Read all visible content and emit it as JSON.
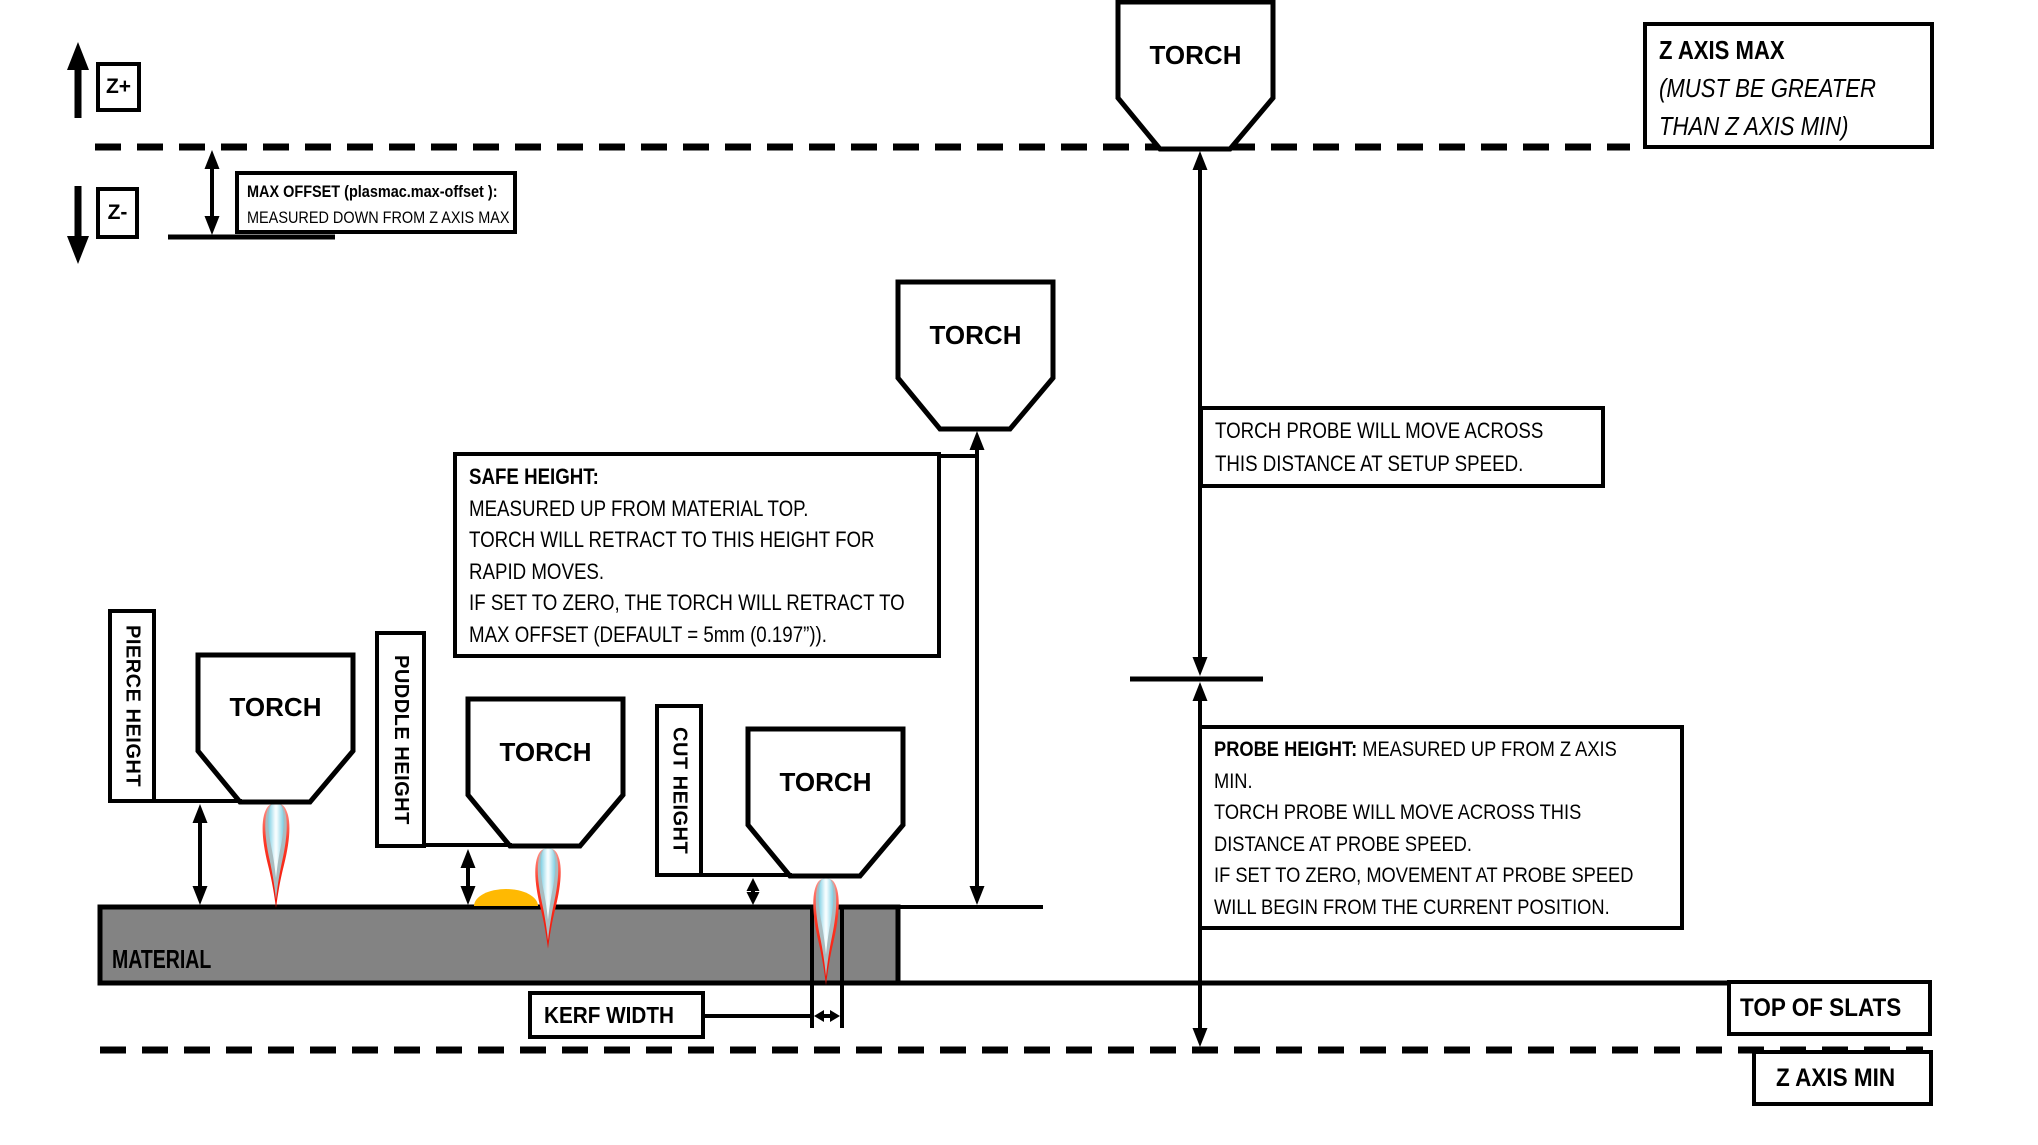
{
  "axis_legend": {
    "z_plus": "Z+",
    "z_minus": "Z-"
  },
  "torch_label": "TORCH",
  "max_offset": {
    "line1": "MAX OFFSET (plasmac.max-offset ):",
    "line2": "MEASURED DOWN FROM Z AXIS MAX"
  },
  "z_axis_max": {
    "title": "Z AXIS MAX",
    "note1": "(MUST BE GREATER",
    "note2": "THAN Z AXIS MIN)"
  },
  "safe_height": {
    "title": "SAFE HEIGHT:",
    "line2": "MEASURED UP FROM MATERIAL TOP.",
    "line3": "TORCH WILL RETRACT TO THIS HEIGHT FOR",
    "line4": "RAPID MOVES.",
    "line5": "IF SET TO ZERO, THE TORCH WILL RETRACT TO",
    "line6": "MAX OFFSET (DEFAULT = 5mm (0.197”))."
  },
  "torch_probe": {
    "line1": "TORCH PROBE WILL MOVE ACROSS",
    "line2": "THIS DISTANCE AT SETUP SPEED."
  },
  "probe_height": {
    "title": "PROBE HEIGHT:",
    "line1_rest": " MEASURED UP FROM Z AXIS",
    "line2": "MIN.",
    "line3": "TORCH PROBE WILL MOVE ACROSS THIS",
    "line4": "DISTANCE AT PROBE SPEED.",
    "line5": "IF SET TO ZERO,  MOVEMENT AT PROBE SPEED",
    "line6": "WILL BEGIN FROM THE CURRENT POSITION."
  },
  "height_labels": {
    "pierce": "PIERCE HEIGHT",
    "puddle": "PUDDLE HEIGHT",
    "cut": "CUT HEIGHT"
  },
  "material_label": "MATERIAL",
  "kerf_width_label": "KERF WIDTH",
  "top_of_slats_label": "TOP OF SLATS",
  "z_axis_min_label": "Z AXIS MIN",
  "colors": {
    "line": "#000000",
    "material_fill": "#838383",
    "puddle_fill": "#ffb902",
    "flame_outer_red": "#fd3a28",
    "flame_mid_gray": "#a9bcc0",
    "flame_inner_blue": "#bfe6f2",
    "background": "#ffffff"
  }
}
